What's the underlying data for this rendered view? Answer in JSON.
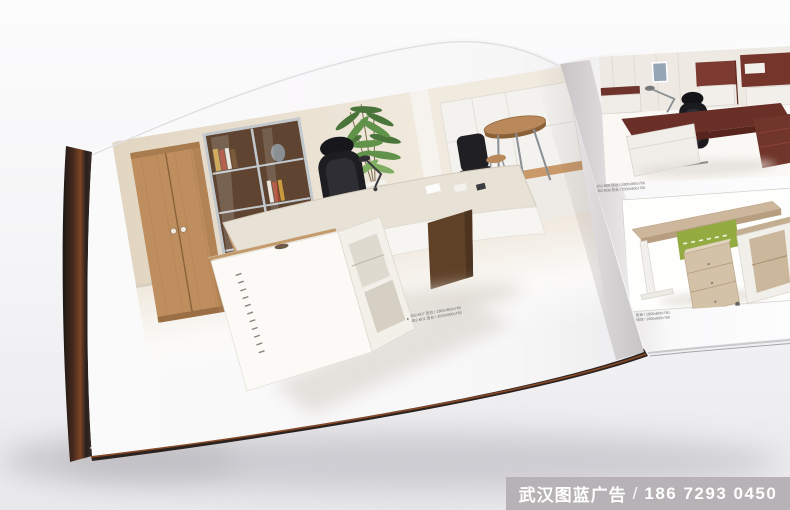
{
  "scene": {
    "description": "Photograph of an open office-furniture catalogue book lying on a white surface",
    "background_color": "#f1f1f4",
    "banner_color": "#b6b2b5"
  },
  "left_page": {
    "logo": {
      "text": "HUNGLONGGUANG 办公家具",
      "subtext": "OFFICE FURNITURE SERIES",
      "mark_color": "#d8681c"
    },
    "photo_alt": "Executive office: maple wardrobe, glass-door bookcase, black leather chair, curved executive desk with white storage cube, potted plant, bar table",
    "caption_marker": "▲",
    "captions": [
      "JB2-B07 班台 / 1800x800x760",
      "JB2-B01 班台 / 2000x900x760"
    ],
    "caption_color": "#6b6b6b"
  },
  "right_page": {
    "top_photo_alt": "Dark mahogany executive desk with black chair and wall cabinets",
    "top_caption_marker": "▲",
    "top_captions": [
      "JB2-B08 班台 / 1800x860x760",
      "JB2-B08 班台 / 2000x900x760"
    ],
    "bottom_photo_alt": "Light oak staff desk with green modesty panel, mobile drawer pedestal and side cabinet",
    "bottom_caption_marker": "▲",
    "bottom_captions": [
      "JB2-B11 班台 / 1800x800x760",
      "JB2-B11 班台 / 1600x800x760"
    ]
  },
  "watermark": {
    "company": "武汉图蓝广告",
    "separator": "/",
    "phone": "186 7293 0450"
  }
}
